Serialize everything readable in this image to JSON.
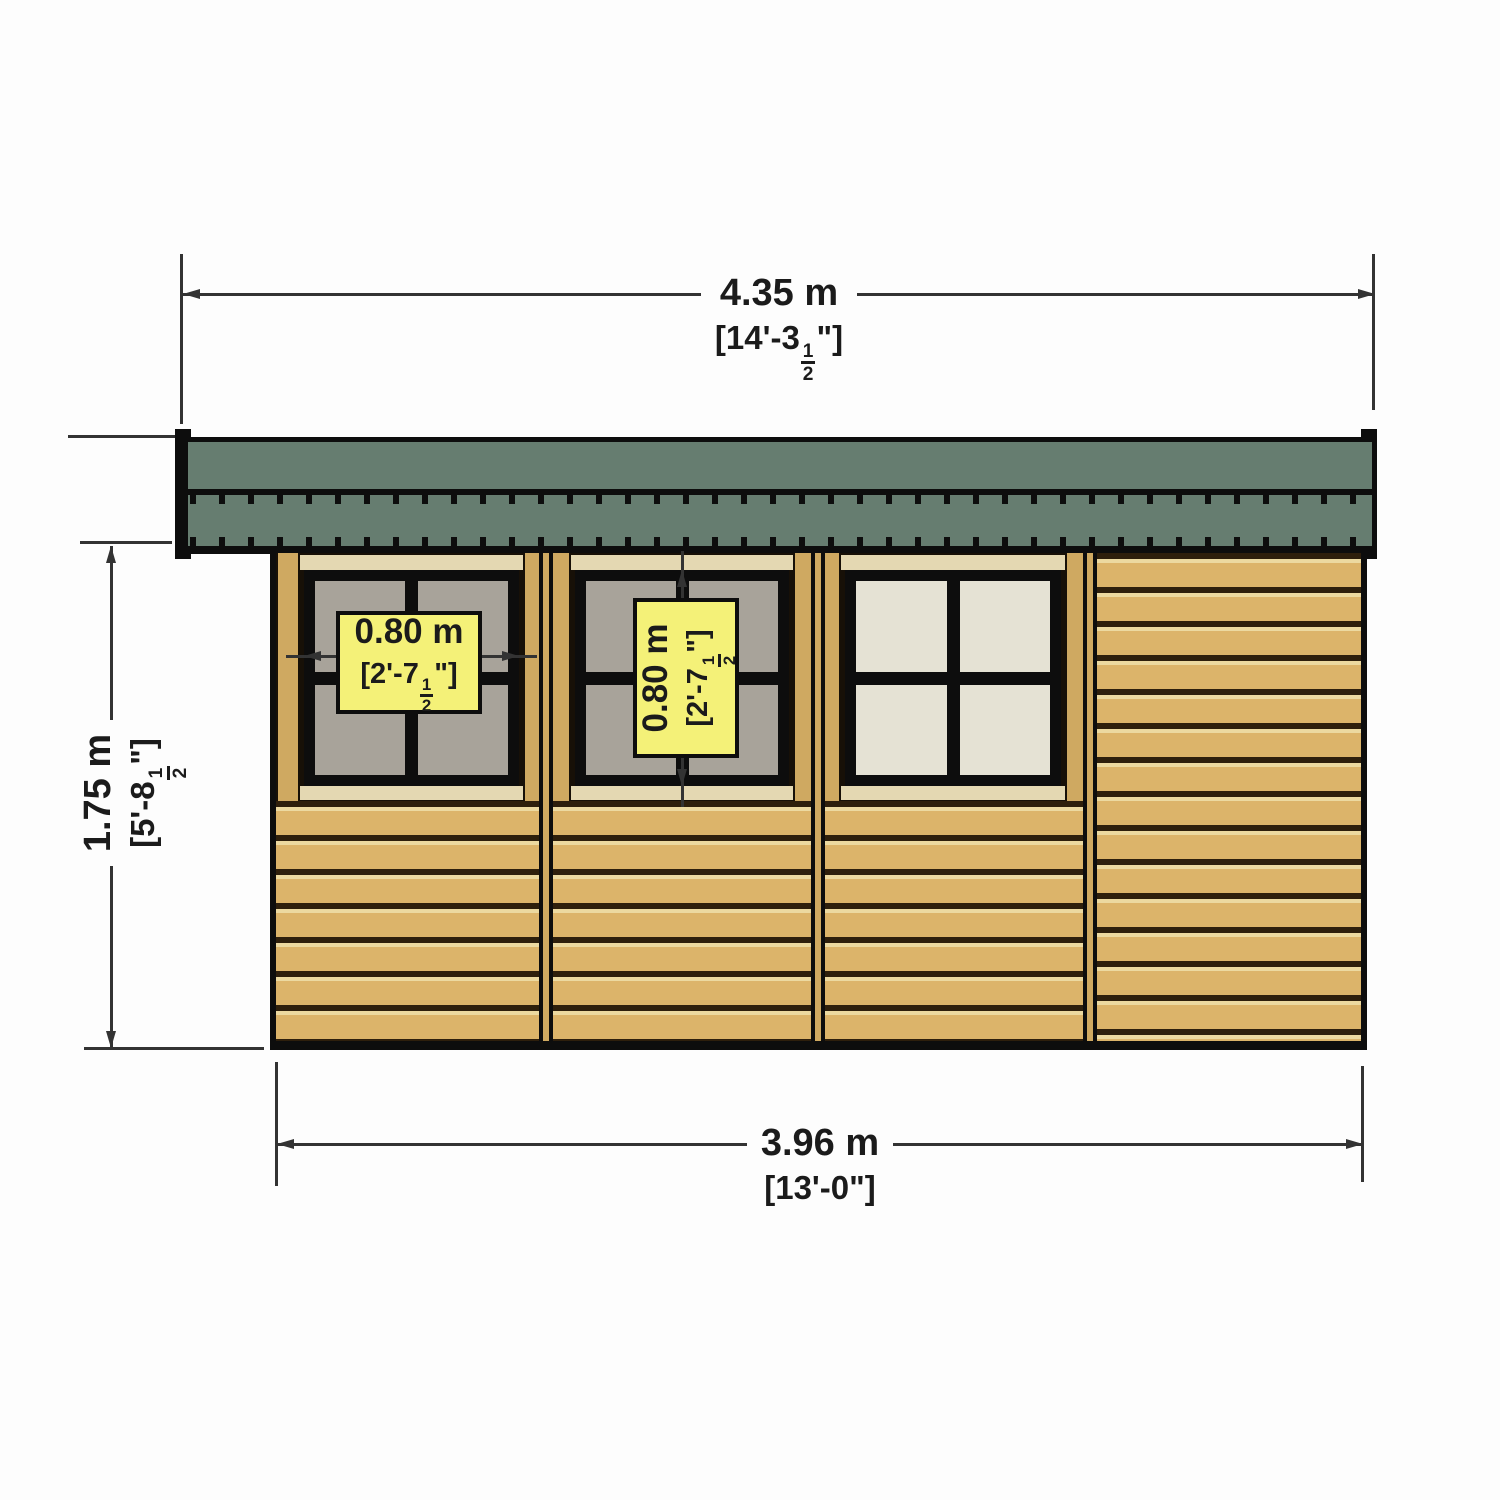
{
  "drawing": {
    "overall_width": {
      "metric": "4.35 m",
      "imperial": "[14'-3½\"]"
    },
    "eaves_height": {
      "metric": "1.75 m",
      "imperial": "[5'-8½\"]"
    },
    "base_width": {
      "metric": "3.96 m",
      "imperial": "[13'-0\"]"
    },
    "window1_width": {
      "metric": "0.80 m",
      "imperial": "[2'-7½\"]"
    },
    "window2_height": {
      "metric": "0.80 m",
      "imperial": "[2'-7½\"]"
    }
  },
  "colors": {
    "bg": "#fdfdfd",
    "dim_line": "#333333",
    "text_color": "#1b1b1b",
    "roof_green": "#667d70",
    "frame_black": "#0d0d0d",
    "plank_tan": "#dcb46a",
    "plank_gap": "#2e1f0c",
    "plank_edge": "#ecd9a0",
    "post_tan": "#cfa961",
    "trim_cream": "#e4d8b2",
    "glass_gray": "#a8a39a",
    "glass_cream": "#e5e2d4",
    "label_yellow": "#f4f178"
  }
}
